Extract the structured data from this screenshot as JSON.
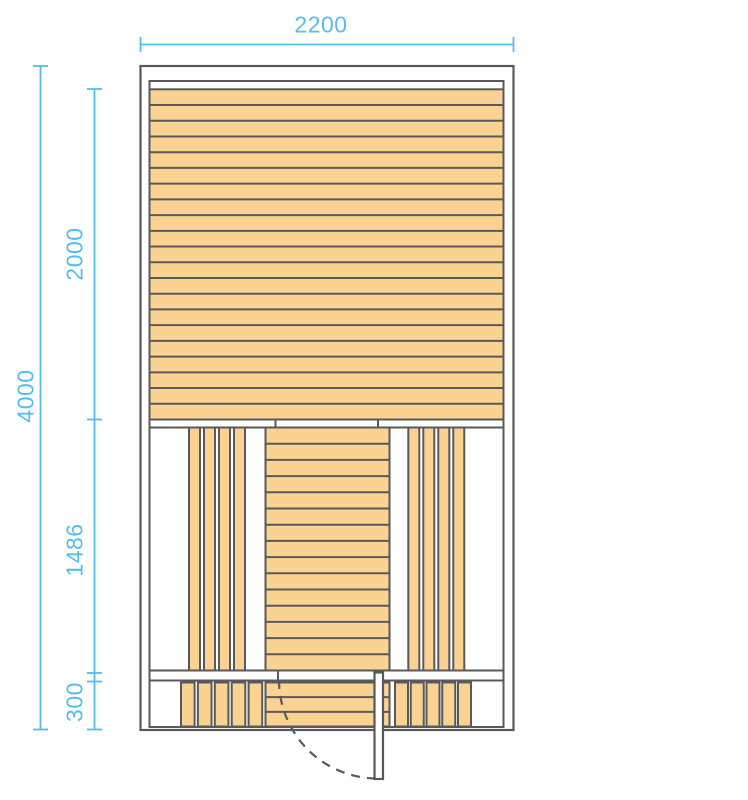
{
  "drawing": {
    "type": "architectural-plan"
  },
  "dimensions": {
    "total_width": "2200",
    "total_height": "4000",
    "upper_section_height": "2000",
    "middle_section_height": "1486",
    "lower_section_height": "300"
  },
  "plan": {
    "upper_section": {
      "pattern": "horizontal-planks",
      "planks": 21
    },
    "middle_section": {
      "left_group": {
        "pattern": "vertical-planks",
        "planks": 4
      },
      "center_column": {
        "pattern": "horizontal-planks",
        "planks": 15
      },
      "right_group": {
        "pattern": "vertical-planks",
        "planks": 4
      }
    },
    "lower_section": {
      "left_group": {
        "pattern": "vertical-planks",
        "planks": 5
      },
      "center_column": {
        "pattern": "horizontal-planks",
        "planks": 3
      },
      "right_group": {
        "pattern": "vertical-planks",
        "planks": 5
      }
    },
    "door": {
      "style": "open-leaf-with-dashed-swing-arc",
      "hinge_side": "right"
    }
  },
  "colors": {
    "dimension": "#55BEE8",
    "wood_fill": "#FAD392",
    "outline": "#58595B",
    "background": "#FFFFFF"
  }
}
